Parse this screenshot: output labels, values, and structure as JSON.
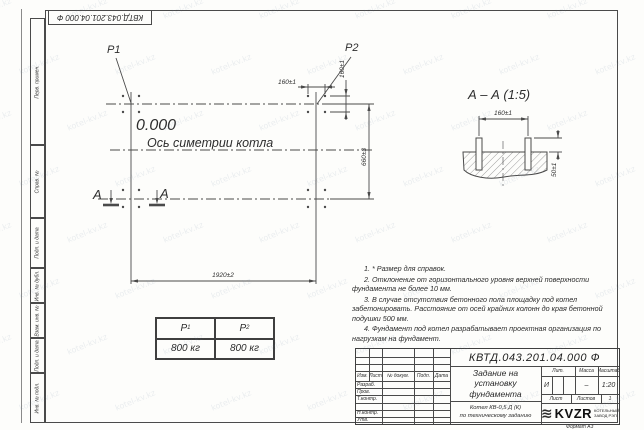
{
  "watermark": {
    "text": "kotel-kv.kz"
  },
  "margin_labels": [
    "Перв. примен.",
    "Справ. №",
    "Подп. и дата",
    "Инв. № дубл.",
    "Взам. инв. №",
    "Подп. и дата",
    "Инв. № подл."
  ],
  "plan": {
    "p1": "P1",
    "p2": "P2",
    "elevation": "0.000",
    "axis_label": "Ось симетрии котла",
    "dim_bolt_h": "160±1",
    "dim_bolt_v": "160±1",
    "dim_width": "660±3",
    "dim_length": "1920±2",
    "section_letter_1": "А",
    "section_letter_2": "А"
  },
  "section": {
    "title": "А – А (1:5)",
    "dim_spacing": "160±1",
    "dim_height": "50±1"
  },
  "load_table": {
    "col1": "Р",
    "col1_sub": "1",
    "col2": "Р",
    "col2_sub": "2",
    "val1": "800 кг",
    "val2": "800 кг"
  },
  "notes": [
    "1. * Размер для справок.",
    "2. Отклонение от горизонтального уровня верхней поверхности фундамента не более 10 мм.",
    "3. В случае отсутствия бетонного пола площадку под котел забетонировать. Расстояние от осей крайних колонн до края бетонной подушки 500 мм.",
    "4. Фундамент под котел разрабатывает проектная организация по нагрузкам на фундамент."
  ],
  "title_block": {
    "doc_number": "КВТД.043.201.04.000 Ф",
    "header_cols": [
      "Изм.",
      "Лист",
      "№ докум.",
      "Подп.",
      "Дата"
    ],
    "rows": [
      "Разраб.",
      "Пров.",
      "Т.контр.",
      "",
      "Н.контр.",
      "Утв."
    ],
    "title_lines": [
      "Задание на",
      "установку",
      "фундамента"
    ],
    "subtitle_lines": [
      "Котел КВ-0,5 Д (К)",
      "по техническому заданию"
    ],
    "lit_label": "Лит.",
    "lit_value": "И",
    "mass_label": "Масса",
    "mass_value": "–",
    "scale_label": "Масштаб",
    "scale_value": "1:20",
    "sheet_label": "Лист",
    "sheets_label": "Листов",
    "sheets_value": "1",
    "logo_text": "KVZR",
    "logo_caption": [
      "КОТЕЛЬНЫЙ",
      "ЗАВОД РЭП"
    ],
    "format_label": "Формат А3"
  }
}
